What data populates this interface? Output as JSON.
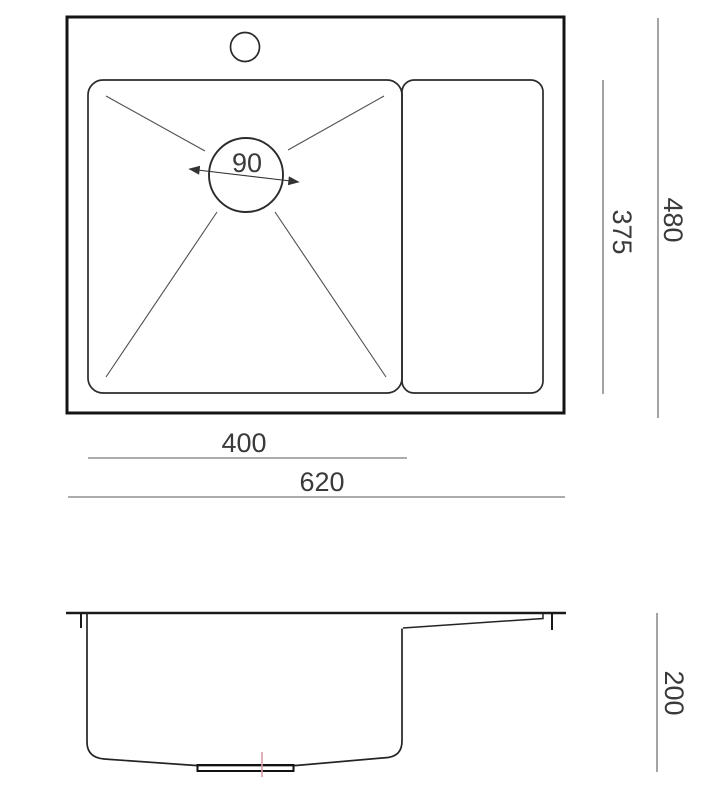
{
  "diagram": {
    "type": "technical-drawing",
    "subject": "kitchen sink with drainboard",
    "views": [
      "top view",
      "side section view"
    ],
    "units": "mm",
    "dimensions": {
      "overall_width": 620,
      "overall_depth": 480,
      "bowl_width": 400,
      "bowl_inner_depth": 375,
      "drain_hole_diameter": 90,
      "bowl_height": 200
    }
  },
  "labels": {
    "drain_diameter": "90",
    "bowl_inner_depth": "375",
    "overall_depth": "480",
    "bowl_width": "400",
    "overall_width": "620",
    "bowl_height": "200"
  },
  "colors": {
    "background": "#ffffff",
    "outline_thick": "#141414",
    "outline": "#2b2b2b",
    "dimension_line": "#5a5a5a",
    "text": "#3a3a3a",
    "drain_centerline": "#d79fa6"
  }
}
